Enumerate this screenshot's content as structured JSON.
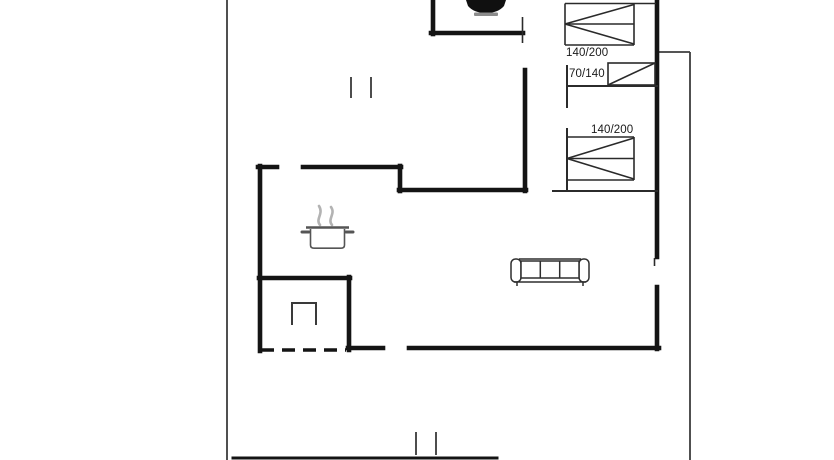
{
  "floorplan": {
    "bed_labels": [
      {
        "id": "bed-top",
        "label": "140/200"
      },
      {
        "id": "bed-small",
        "label": "70/140"
      },
      {
        "id": "bed-lower",
        "label": "140/200"
      }
    ],
    "symbols": [
      {
        "name": "toilet-icon"
      },
      {
        "name": "cooking-pot-icon"
      },
      {
        "name": "steam-icon"
      },
      {
        "name": "sofa-icon"
      },
      {
        "name": "double-bed-icon"
      },
      {
        "name": "cot-bed-icon"
      },
      {
        "name": "furnace-icon"
      },
      {
        "name": "window-marker-top"
      },
      {
        "name": "window-marker-bottom"
      }
    ],
    "colors": {
      "background": "#ffffff",
      "wall": "#141414",
      "partition": "#2b2b2b",
      "furniture": "#2e2e2e",
      "boundary": "#3d3d3d",
      "steam": "#b3b3b3",
      "label_text": "#1a1a1a"
    }
  }
}
